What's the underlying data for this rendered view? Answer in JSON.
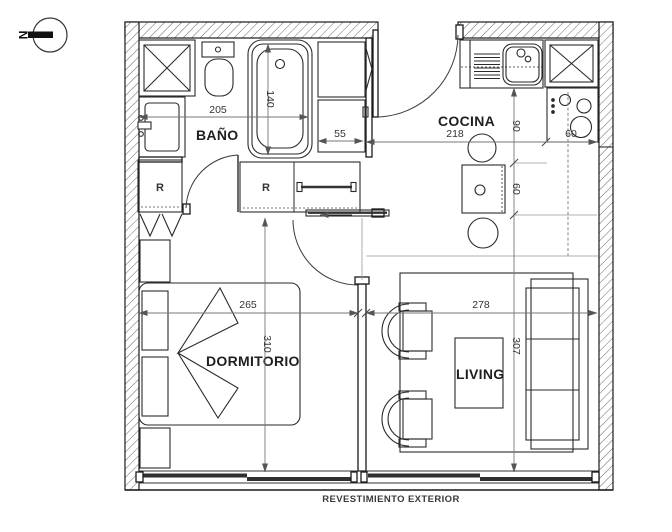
{
  "compass": {
    "label": "N"
  },
  "rooms": {
    "bathroom": "BAÑO",
    "kitchen": "COCINA",
    "bedroom": "DORMITORIO",
    "living": "LIVING"
  },
  "closets": {
    "bathroom_closet": "R",
    "hall_closet": "R"
  },
  "dimensions_cm": {
    "bathroom_width": "205",
    "bathtub_length": "140",
    "entry_cabinet_width": "55",
    "kitchen_width": "218",
    "kitchen_counter_depth": "90",
    "kitchen_table_zone": "60",
    "stove_width": "60",
    "bedroom_width": "265",
    "bedroom_depth": "310",
    "living_width": "278",
    "living_depth": "307"
  },
  "footer": {
    "exterior_finish_label": "REVESTIMIENTO EXTERIOR"
  },
  "colors": {
    "wall_line": "#1a1a1a",
    "dimension": "#555555",
    "glazing": "#2f2f2f",
    "background": "#ffffff"
  }
}
